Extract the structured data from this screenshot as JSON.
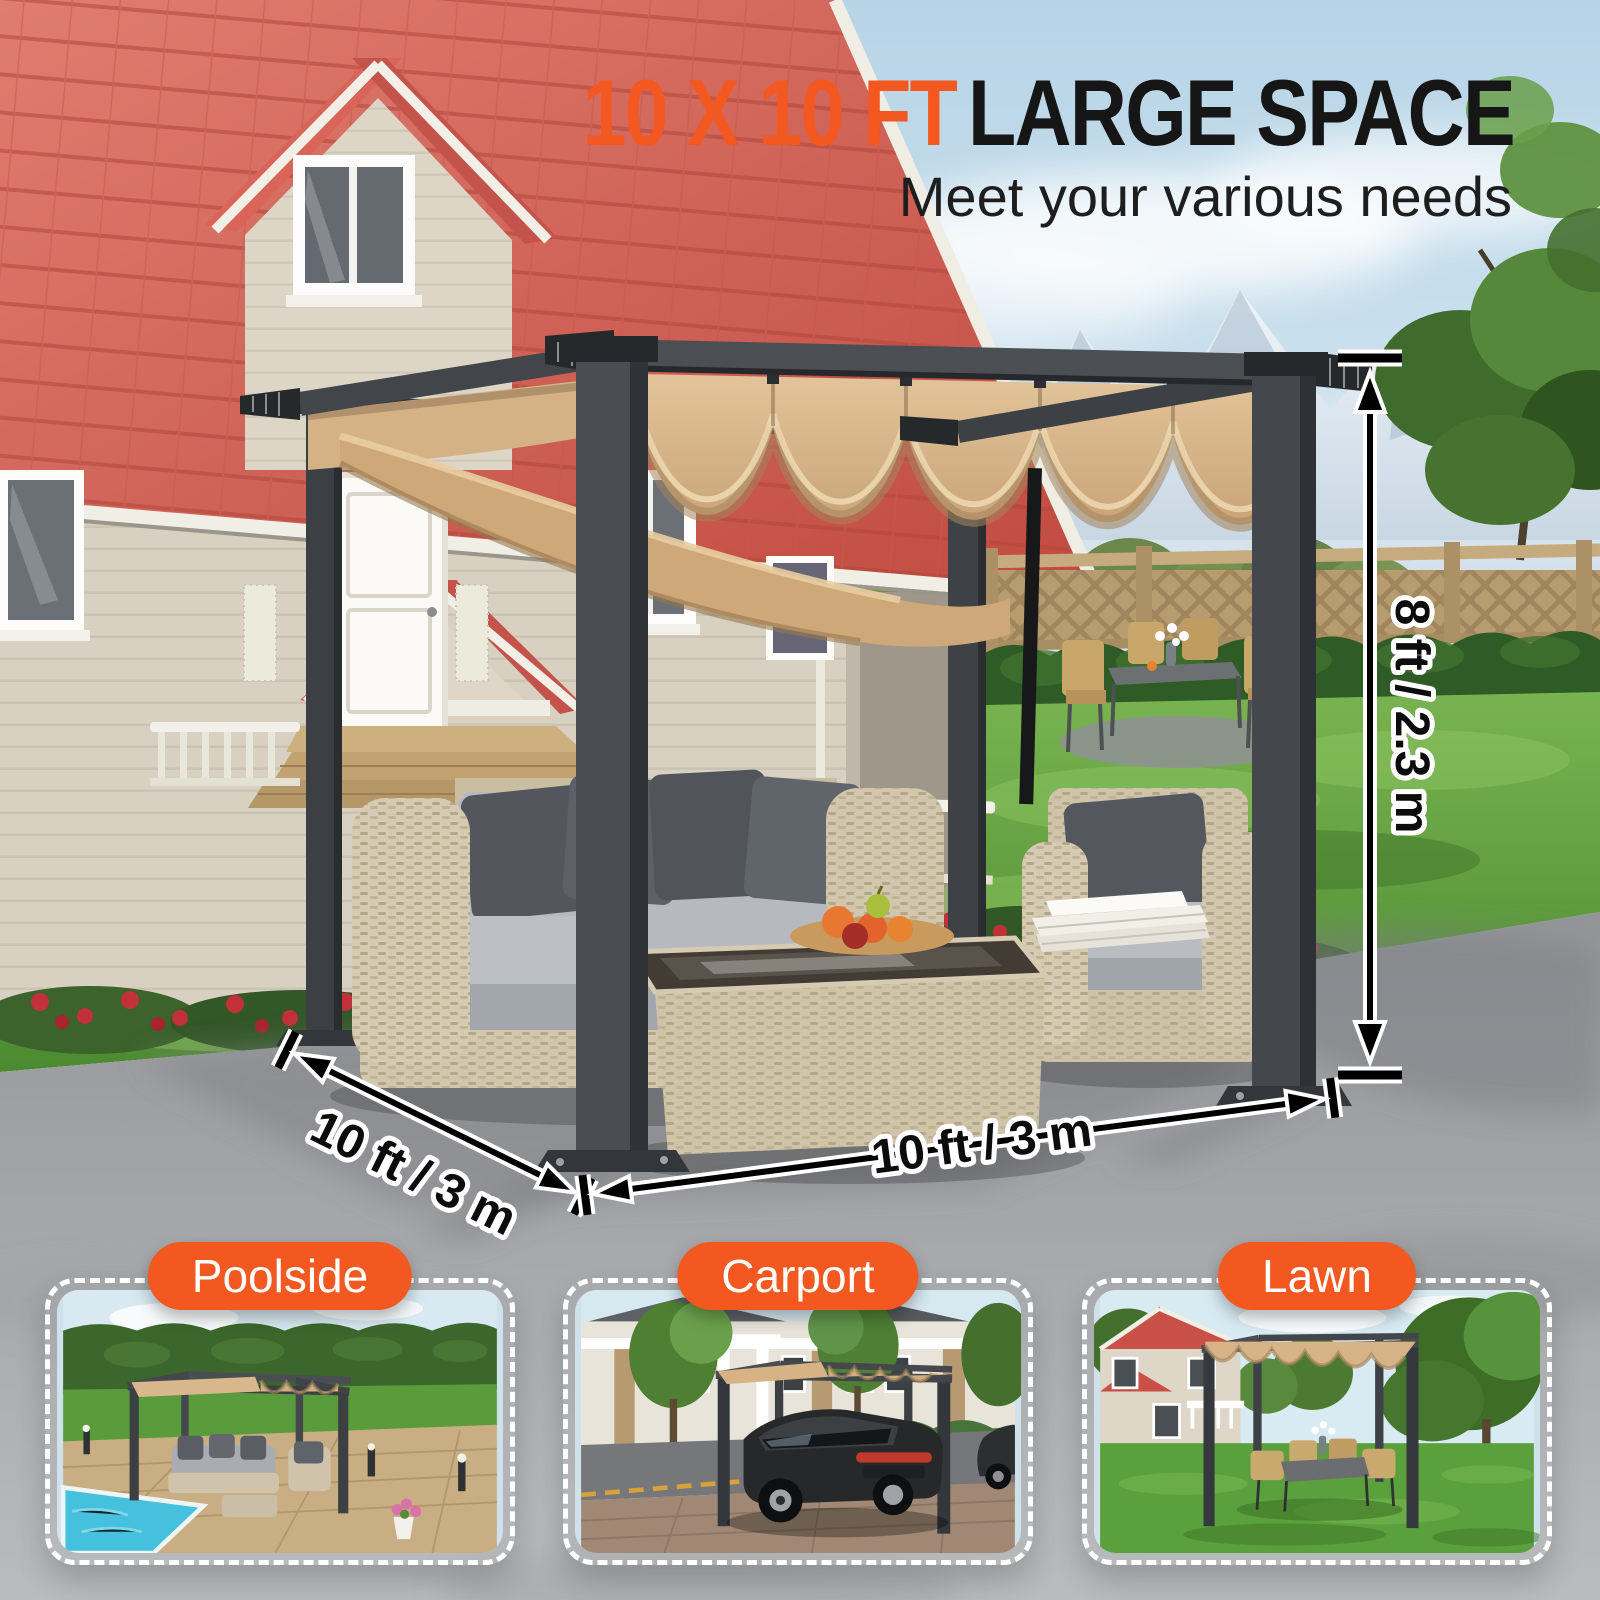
{
  "headline": {
    "highlight": "10 X 10 FT",
    "rest": "LARGE SPACE",
    "subtitle": "Meet your various needs"
  },
  "dimensions": {
    "height": "8 ft / 2.3 m",
    "depth": "10 ft / 3 m",
    "width": "10 ft / 3 m"
  },
  "thumbnails": [
    {
      "label": "Poolside"
    },
    {
      "label": "Carport"
    },
    {
      "label": "Lawn"
    }
  ],
  "colors": {
    "accent_orange": "#f2581f",
    "headline_text": "#161616",
    "canopy_tan": "#d8b78c",
    "pergola_frame": "#3f4347",
    "house_roof_red": "#cf5148",
    "house_siding": "#d8d1c2",
    "lawn_green": "#5da23e",
    "patio_gray": "#a9abad",
    "dimension_line": "#000000",
    "dimension_outline": "#ffffff"
  }
}
